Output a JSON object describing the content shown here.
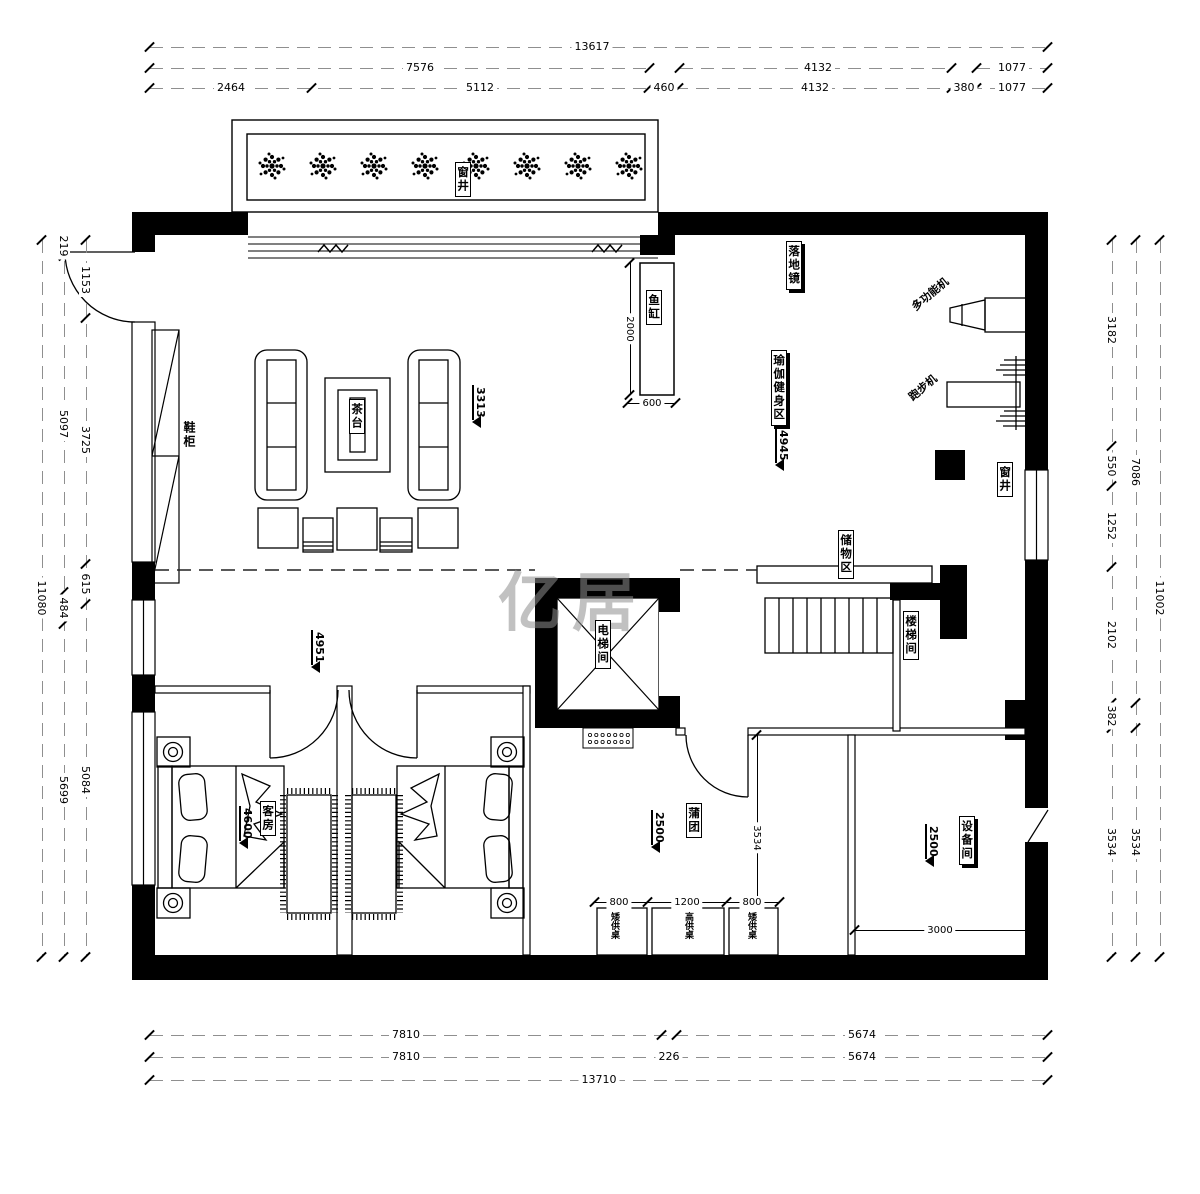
{
  "watermark": "亿居",
  "labels": {
    "light_well_top": "窗井",
    "light_well_right": "窗井",
    "shoe_cabinet": "鞋柜",
    "tea_table": "茶台",
    "fish_tank": "鱼缸",
    "floor_mirror": "落地镜",
    "multi_gym": "多功能机",
    "treadmill": "跑步机",
    "yoga_area": "瑜伽健身区",
    "storage_area": "储物区",
    "stair_room": "楼梯间",
    "elevator_room": "电梯间",
    "guest_room": "客房",
    "prayer_cushion": "蒲团",
    "low_altar_left": "矮供桌",
    "high_altar": "高供桌",
    "low_altar_right": "矮供桌",
    "equipment_room": "设备间"
  },
  "elevations": {
    "living": "3313",
    "yoga": "4945",
    "hallway": "4951",
    "guest": "4600",
    "prayer": "2500",
    "equipment": "2500"
  },
  "dims": {
    "top1": [
      "13617"
    ],
    "top2": [
      "7576",
      "4132",
      "1077"
    ],
    "top3": [
      "2464",
      "5112",
      "460",
      "4132",
      "380",
      "1077"
    ],
    "bottom1": [
      "7810",
      "5674"
    ],
    "bottom2": [
      "7810",
      "226",
      "5674"
    ],
    "bottom3": [
      "13710"
    ],
    "left_outer": [
      "11080"
    ],
    "left_mid": [
      "219",
      "5097",
      "484",
      "5699"
    ],
    "left_inner": [
      "1153",
      "3725",
      "615",
      "5084"
    ],
    "right_inner": [
      "3182",
      "550",
      "1252",
      "2102",
      "382",
      "3534"
    ],
    "right_mid": [
      "7086",
      "3534"
    ],
    "right_outer": [
      "11002"
    ],
    "fish_h": "2000",
    "fish_w": "600",
    "prayer_v": "3534",
    "desks": [
      "800",
      "1200",
      "800"
    ],
    "equip_w": "3000"
  }
}
